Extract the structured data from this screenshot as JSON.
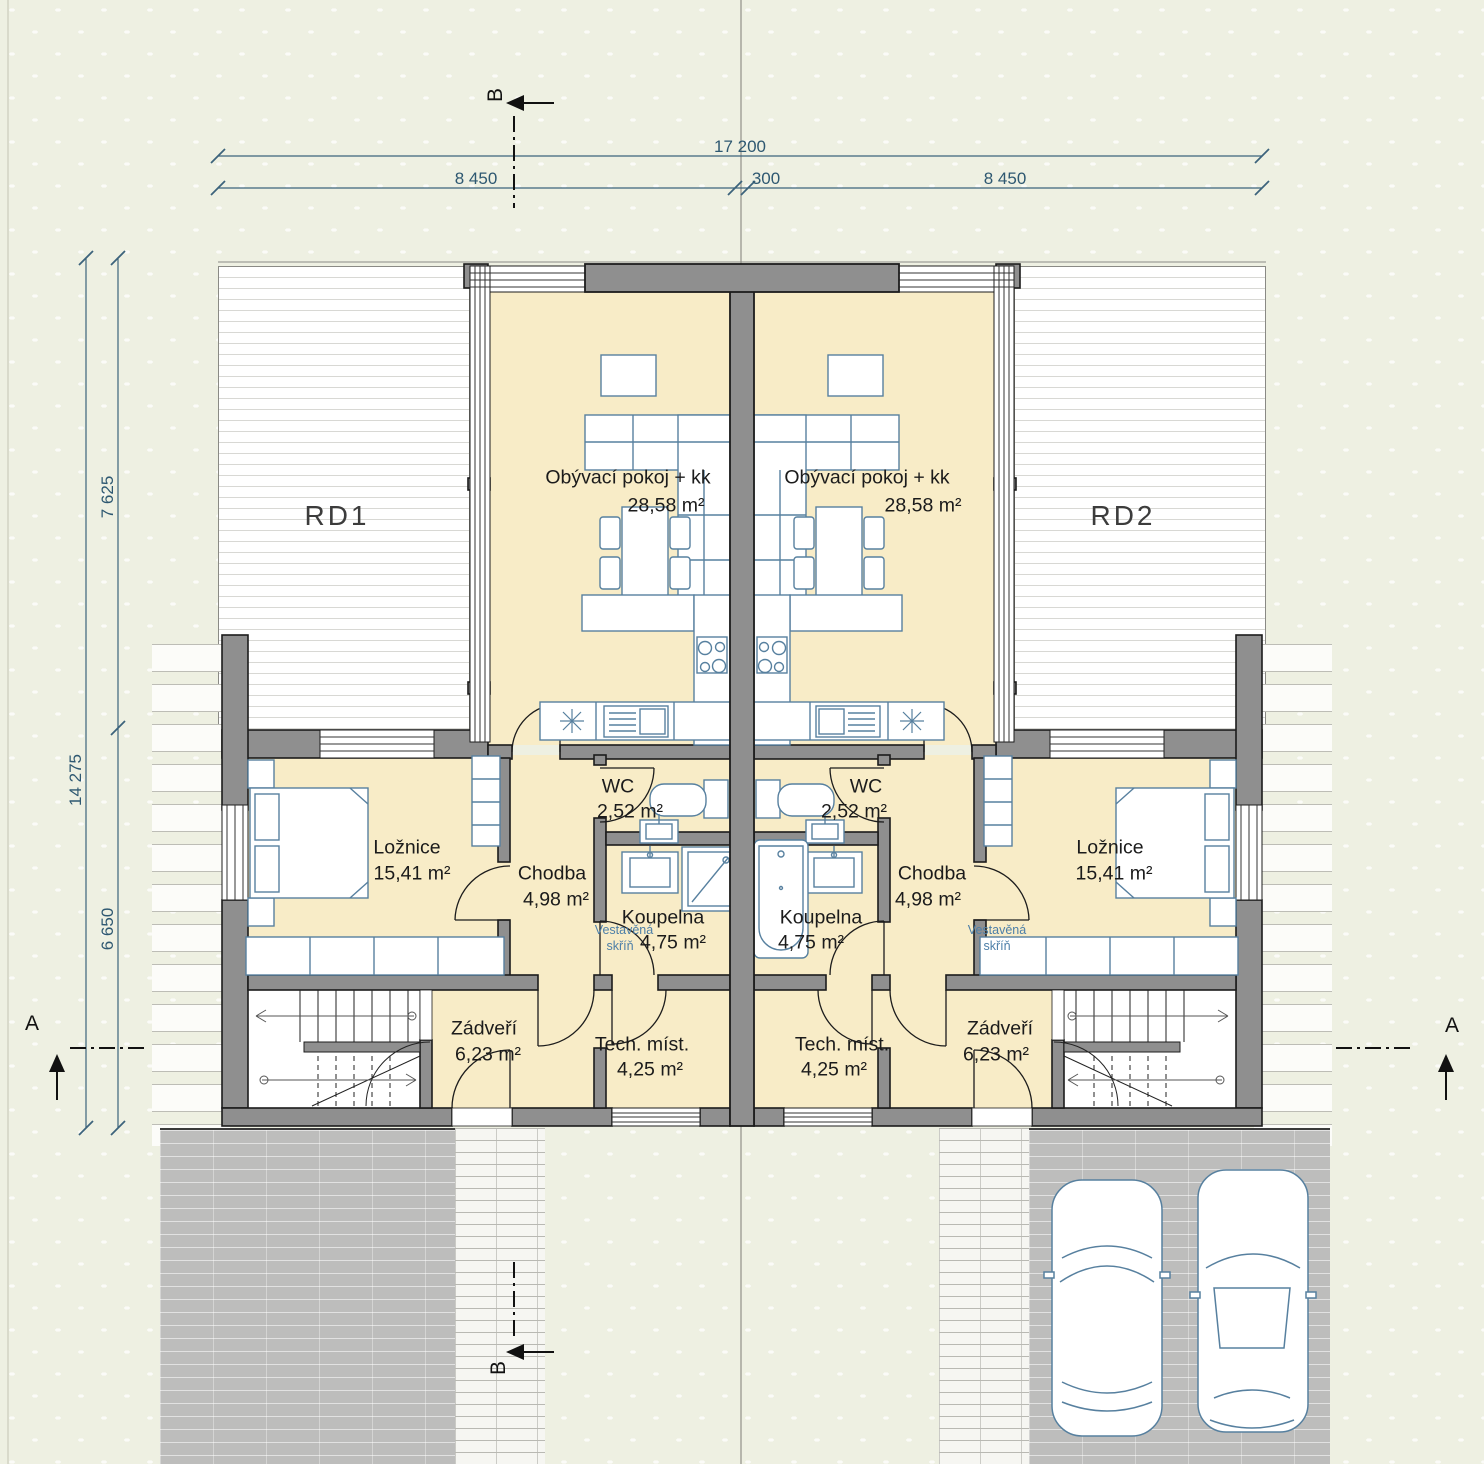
{
  "dimensions": {
    "total_width": "17 200",
    "left_width": "8 450",
    "gap": "300",
    "right_width": "8 450",
    "total_depth": "14 275",
    "upper_depth": "7 625",
    "lower_depth": "6 650"
  },
  "section_markers": {
    "b_top": "B",
    "b_bottom": "B",
    "a_left": "A",
    "a_right": "A"
  },
  "zones": {
    "rd1": "RD1",
    "rd2": "RD2"
  },
  "units": {
    "rd1": {
      "living": {
        "name": "Obývací pokoj + kk",
        "area": "28,58 m²"
      },
      "bedroom": {
        "name": "Ložnice",
        "area": "15,41 m²"
      },
      "hall": {
        "name": "Chodba",
        "area": "4,98 m²"
      },
      "wc": {
        "name": "WC",
        "area": "2,52 m²"
      },
      "bathroom": {
        "name": "Koupelna",
        "area": "4,75 m²"
      },
      "entry": {
        "name": "Zádveří",
        "area": "6,23 m²"
      },
      "tech": {
        "name": "Tech. míst.",
        "area": "4,25 m²"
      },
      "wardrobe": {
        "line1": "Vestavěná",
        "line2": "skříň"
      }
    },
    "rd2": {
      "living": {
        "name": "Obývací pokoj + kk",
        "area": "28,58 m²"
      },
      "bedroom": {
        "name": "Ložnice",
        "area": "15,41 m²"
      },
      "hall": {
        "name": "Chodba",
        "area": "4,98 m²"
      },
      "wc": {
        "name": "WC",
        "area": "2,52 m²"
      },
      "bathroom": {
        "name": "Koupelna",
        "area": "4,75 m²"
      },
      "entry": {
        "name": "Zádveří",
        "area": "6,23 m²"
      },
      "tech": {
        "name": "Tech. míst.",
        "area": "4,25 m²"
      },
      "wardrobe": {
        "line1": "Vestavěná",
        "line2": "skříň"
      }
    }
  },
  "colors": {
    "background": "#eef0e2",
    "room_fill": "#f8ecc7",
    "wall": "#8f8f8f",
    "furniture_line": "#57809f",
    "dimension_line": "#3c637c",
    "terrace_line": "#d8d8d4"
  }
}
